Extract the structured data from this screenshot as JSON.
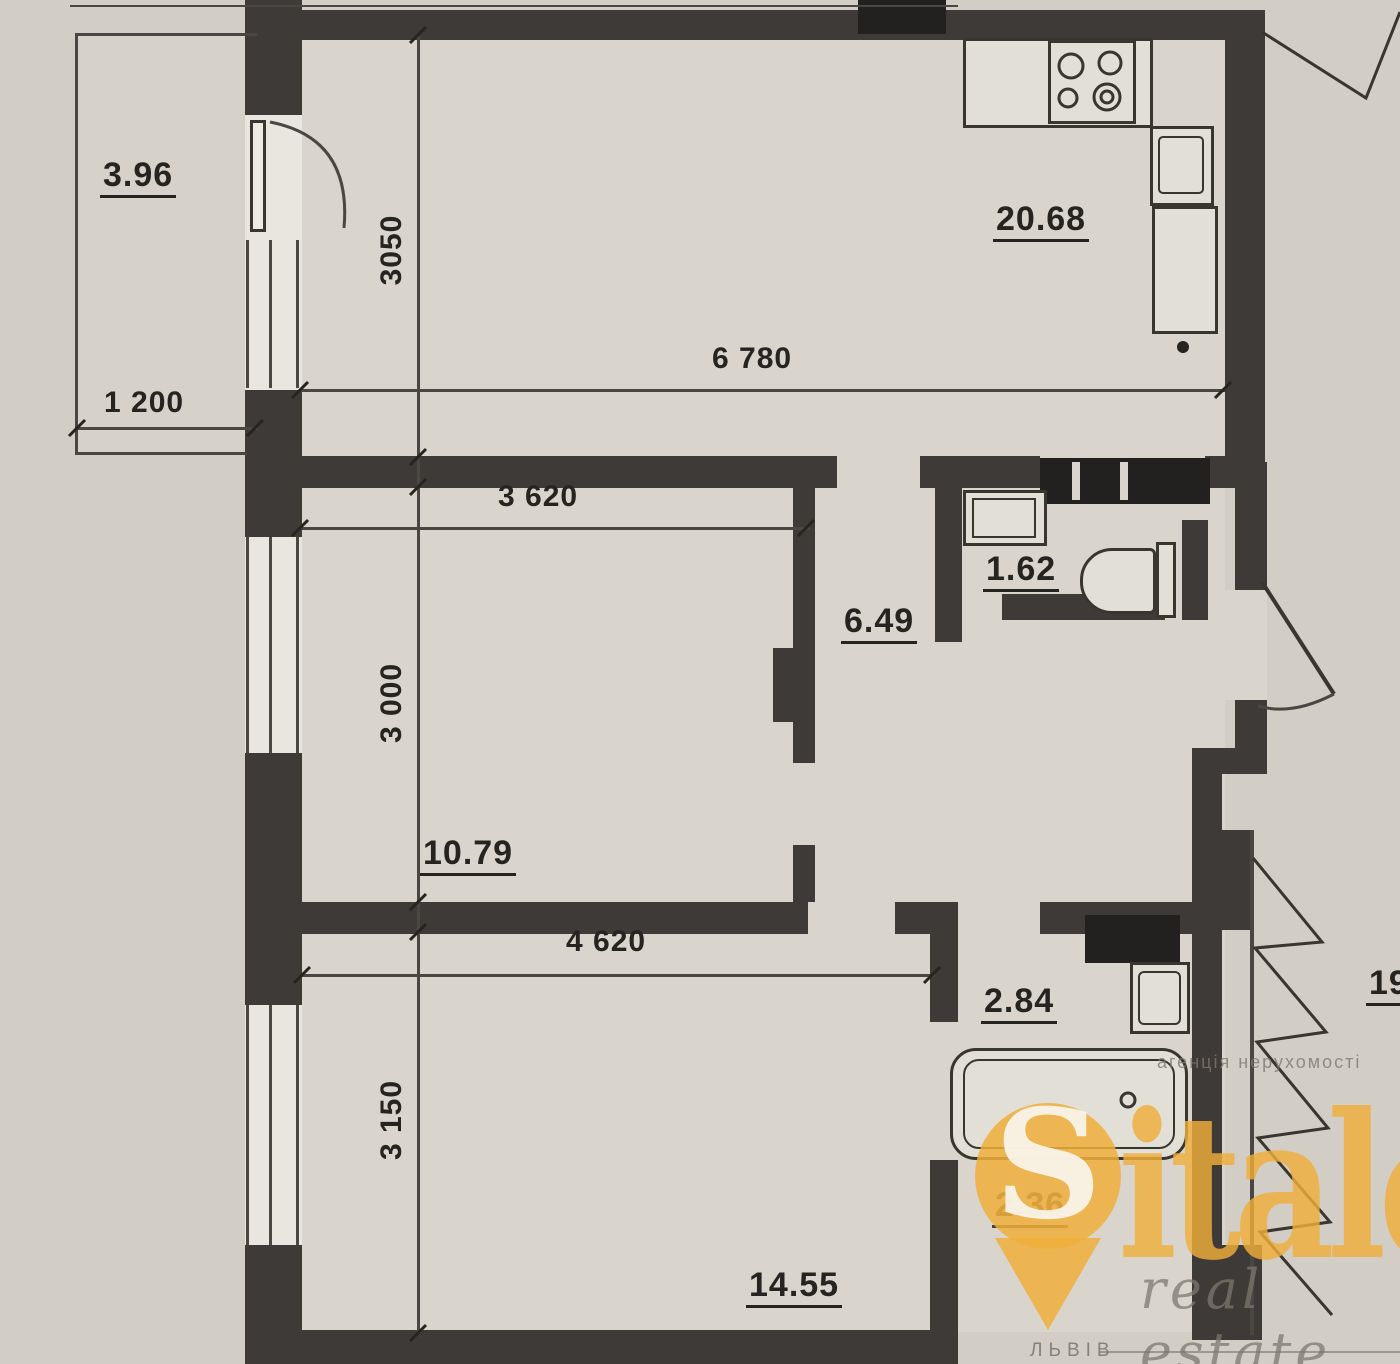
{
  "plan": {
    "labels": {
      "balcony_left": "3.96",
      "kitchen_living": "20.68",
      "wc": "1.62",
      "hallway": "6.49",
      "bedroom1": "10.79",
      "bathroom": "2.84",
      "bedroom2": "14.55",
      "corridor": "2.36",
      "balcony_right": "19"
    },
    "dimensions": {
      "balcony_width": "1 200",
      "kitchen_depth": "3050",
      "kitchen_width": "6 780",
      "bedroom1_width": "3 620",
      "bedroom1_depth": "3 000",
      "bedroom2_width": "4 620",
      "bedroom2_depth": "3 150"
    }
  },
  "watermark": {
    "logo_initial": "S",
    "logo_rest": "italo",
    "agency_line": "агенція нерухомості",
    "tagline": "real estate",
    "city": "ЛЬВІВ"
  },
  "colors": {
    "wall": "#3E3A37",
    "gold": "#EFAF3B",
    "paper": "#D3CFC6"
  }
}
